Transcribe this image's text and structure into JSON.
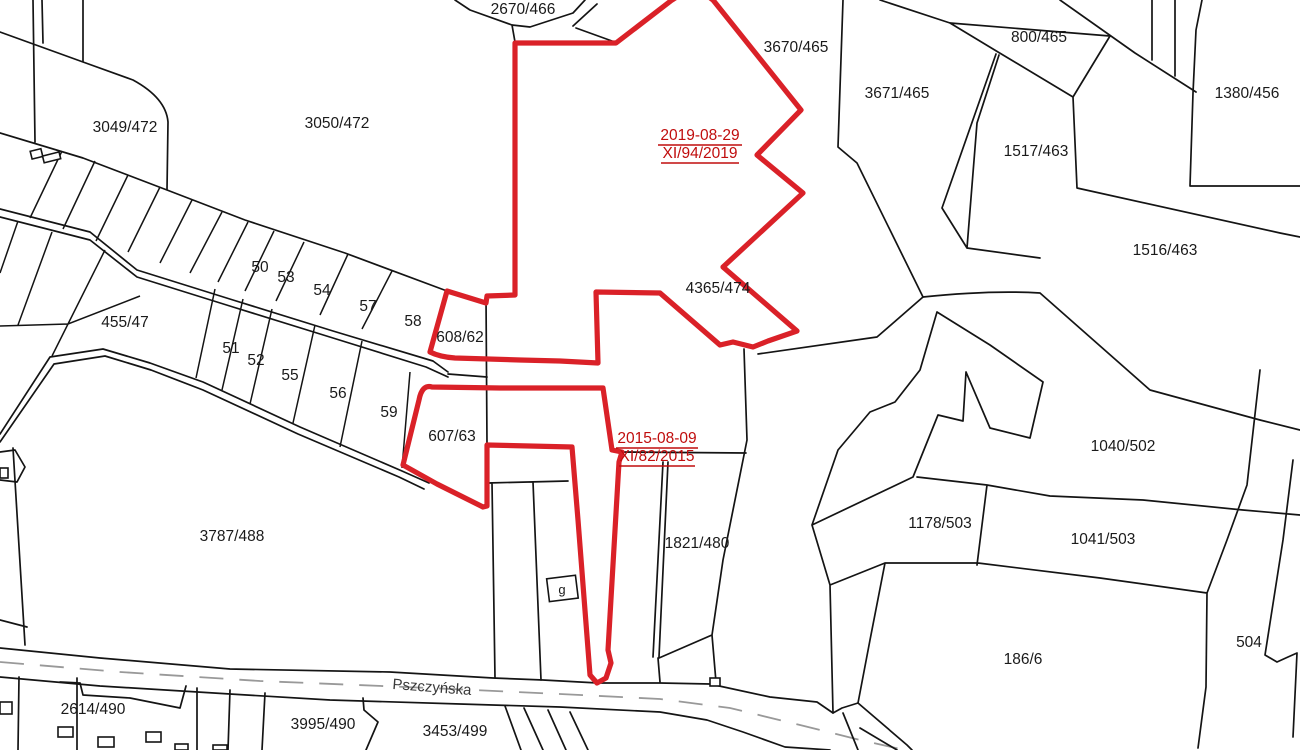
{
  "map": {
    "type": "cadastral-parcel-map",
    "street": {
      "name": "Pszczyńska"
    },
    "building_label": "g"
  },
  "parcels": [
    {
      "id": "3049/472"
    },
    {
      "id": "3050/472"
    },
    {
      "id": "2670/466"
    },
    {
      "id": "3670/465"
    },
    {
      "id": "3671/465"
    },
    {
      "id": "800/465"
    },
    {
      "id": "1380/456"
    },
    {
      "id": "1517/463"
    },
    {
      "id": "1516/463"
    },
    {
      "id": "4365/474"
    },
    {
      "id": "455/47"
    },
    {
      "id": "50"
    },
    {
      "id": "53"
    },
    {
      "id": "54"
    },
    {
      "id": "57"
    },
    {
      "id": "58"
    },
    {
      "id": "608/62"
    },
    {
      "id": "51"
    },
    {
      "id": "52"
    },
    {
      "id": "55"
    },
    {
      "id": "56"
    },
    {
      "id": "59"
    },
    {
      "id": "607/63"
    },
    {
      "id": "1040/502"
    },
    {
      "id": "1178/503"
    },
    {
      "id": "1041/503"
    },
    {
      "id": "3787/488"
    },
    {
      "id": "1821/480"
    },
    {
      "id": "186/6"
    },
    {
      "id": "504"
    },
    {
      "id": "2614/490"
    },
    {
      "id": "3995/490"
    },
    {
      "id": "3453/499"
    }
  ],
  "annotations": [
    {
      "date": "2019-08-29",
      "case_number": "XI/94/2019"
    },
    {
      "date": "2015-08-09",
      "case_number": "XI/82/2015"
    }
  ],
  "colors": {
    "background": "#ffffff",
    "boundary": "#141414",
    "highlight": "#da2128",
    "annotation": "#c00d0d",
    "road-dash": "#999999",
    "label": "#1a1a1a",
    "street": "#3a3a3a"
  }
}
